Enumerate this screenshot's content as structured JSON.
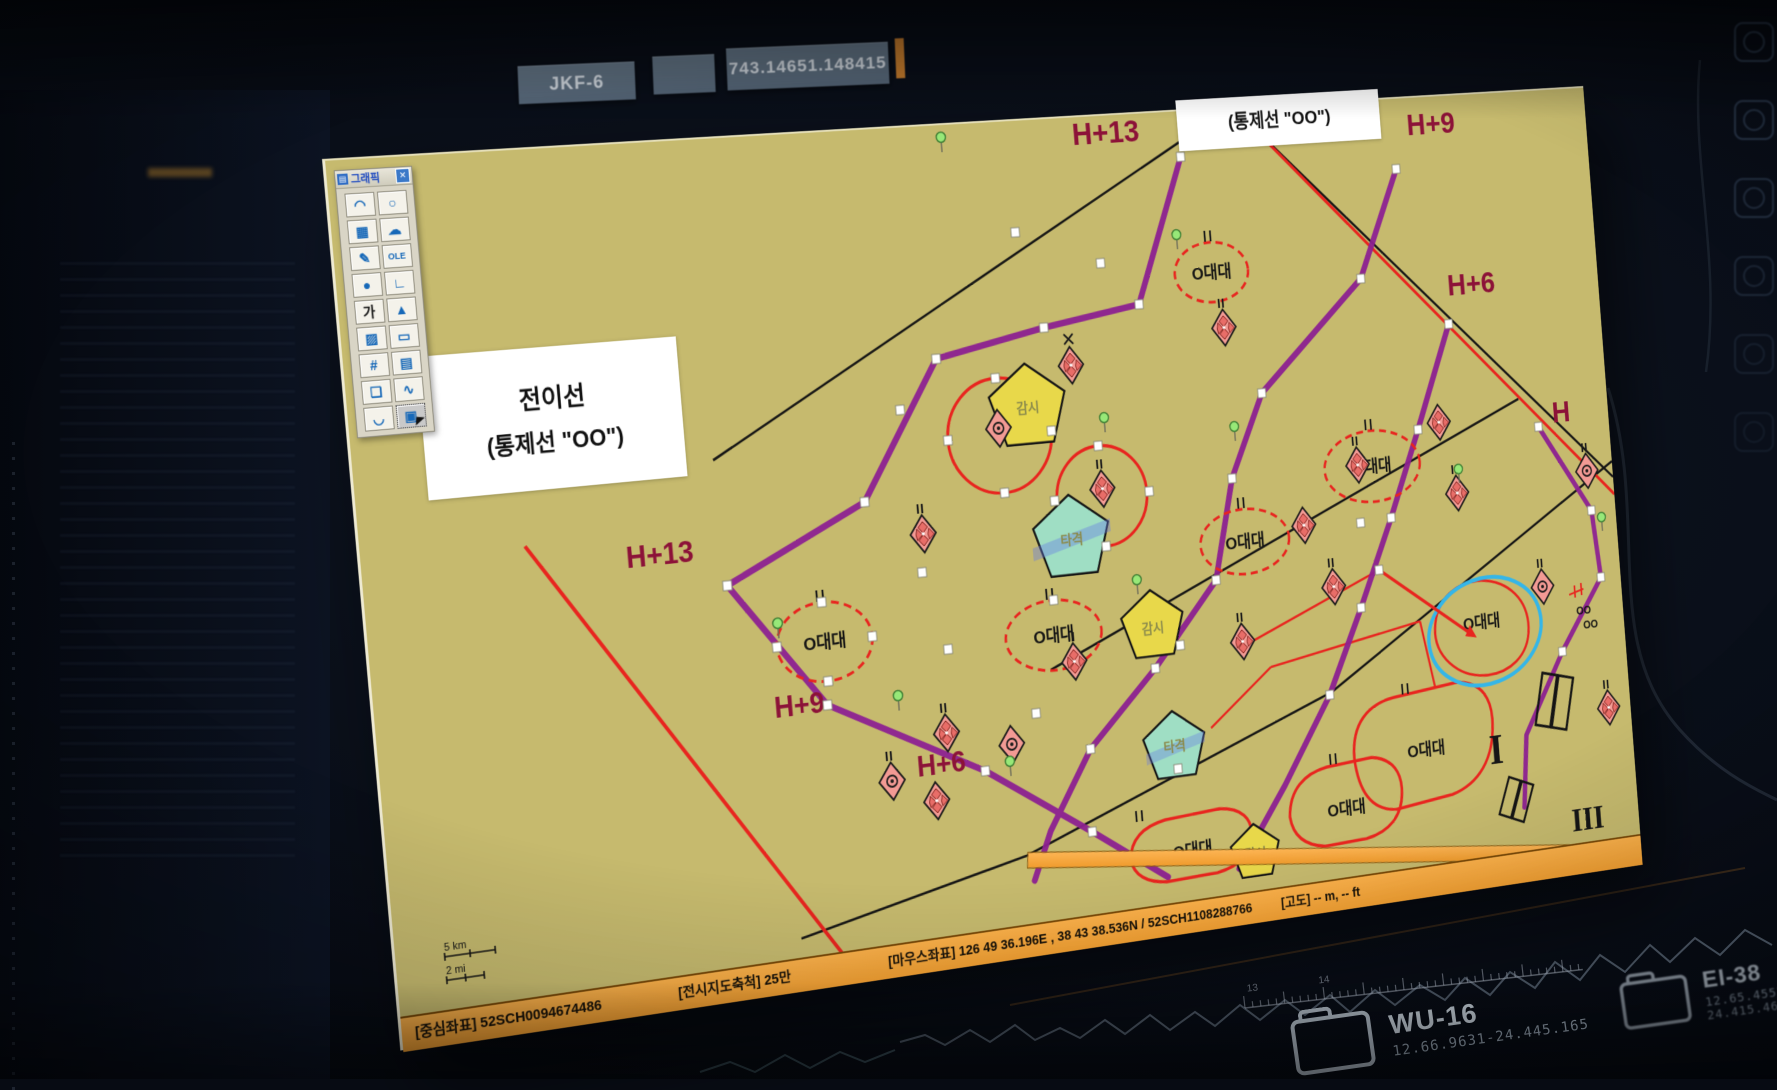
{
  "topbar": {
    "tab_label": "JKF-6",
    "coordinate_value": "743.14651.148415"
  },
  "palette": {
    "title": "그래픽",
    "close_glyph": "✕",
    "tools": [
      {
        "glyph": "◠",
        "name": "arc-tool"
      },
      {
        "glyph": "○",
        "name": "ellipse-tool"
      },
      {
        "glyph": "▦",
        "name": "image-tool"
      },
      {
        "glyph": "☁",
        "name": "blob-tool"
      },
      {
        "glyph": "✎",
        "name": "pen-tool"
      },
      {
        "glyph": "OLE",
        "name": "ole-tool"
      },
      {
        "glyph": "●",
        "name": "point-tool"
      },
      {
        "glyph": "∟",
        "name": "step-line-tool"
      },
      {
        "glyph": "가",
        "name": "text-tool"
      },
      {
        "glyph": "▲",
        "name": "triangle-tool"
      },
      {
        "glyph": "▨",
        "name": "hatch-tool"
      },
      {
        "glyph": "▭",
        "name": "rect-tool"
      },
      {
        "glyph": "#",
        "name": "grid-tool"
      },
      {
        "glyph": "▤",
        "name": "table-tool"
      },
      {
        "glyph": "❏",
        "name": "callout-tool"
      },
      {
        "glyph": "∿",
        "name": "curve-tool"
      },
      {
        "glyph": "◡",
        "name": "arc2-tool"
      },
      {
        "glyph": "▣",
        "name": "stamp-tool-selected"
      }
    ]
  },
  "map": {
    "overlay": {
      "control_line": "(통제선 \"OO\")",
      "transition_title": "전이선",
      "transition_sub": "(통제선 \"OO\")"
    },
    "phase_labels": [
      {
        "text": "H+13"
      },
      {
        "text": "H+9"
      },
      {
        "text": "H+6"
      },
      {
        "text": "H"
      },
      {
        "text": "H+13"
      },
      {
        "text": "H+9"
      },
      {
        "text": "H+6"
      }
    ],
    "unit_label": "O대대",
    "surveillance_label": "감시",
    "strike_label": "타격",
    "oo_label": "OO",
    "roman_one": "I",
    "roman_three": "III",
    "scale_km": "5 km",
    "scale_mi": "2 mi",
    "statusbar": {
      "center": "[중심좌표] 52SCH0094674486",
      "scale": "[전시지도축척]  25만",
      "mouse": "[마우스좌표] 126 49 36.196E , 38 43 38.536N / 52SCH1108288766",
      "altitude": "[고도] -- m, -- ft"
    }
  },
  "bottom_files": [
    {
      "name": "WU-16",
      "id": "12.66.9631-24.445.165"
    },
    {
      "name": "EI-38",
      "id": "12.65.4553-24.415.464"
    }
  ],
  "ruler_numbers": [
    "13",
    "14"
  ]
}
